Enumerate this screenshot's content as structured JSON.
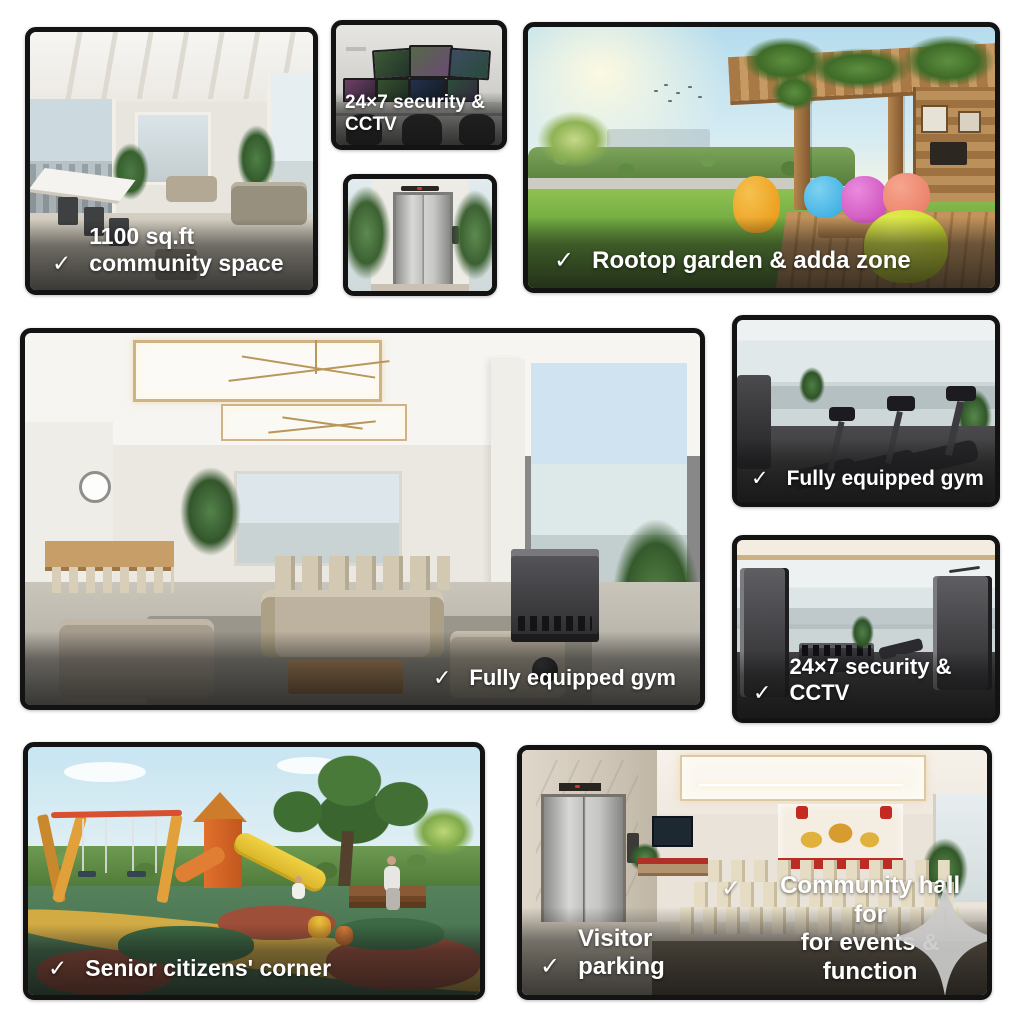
{
  "collage": {
    "background": "#ffffff",
    "tile_border_color": "#131313",
    "caption_text_color": "#ffffff"
  },
  "icons": {
    "check": "✓",
    "sparkle_color": "#cbcbcb"
  },
  "tiles": {
    "community_space": {
      "caption": "1100 sq.ft community space"
    },
    "cctv_room": {
      "caption": "24×7 security & CCTV"
    },
    "rooftop_garden": {
      "caption": "Rootop garden & adda zone"
    },
    "lounge_gym": {
      "caption": "Fully equipped gym"
    },
    "treadmill_gym": {
      "caption": "Fully equipped gym"
    },
    "strength_gym": {
      "caption": "24×7 security & CCTV"
    },
    "playground": {
      "caption": "Senior citizens' corner"
    },
    "community_hall": {
      "caption_left": "Visitor parking",
      "caption_right_line1": "Community hall for",
      "caption_right_line2": "for events & function"
    }
  }
}
